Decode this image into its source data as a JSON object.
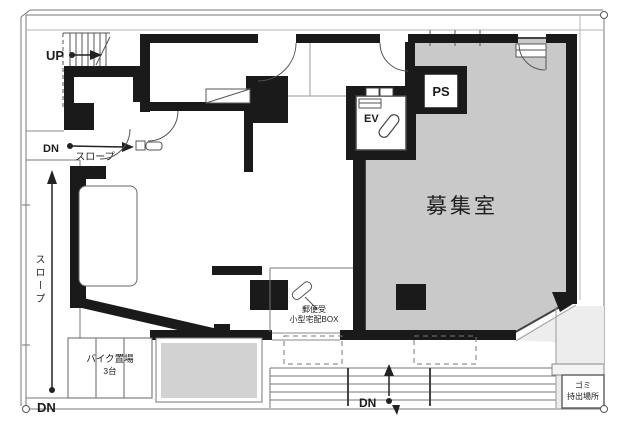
{
  "plan": {
    "room": {
      "name": "募集室"
    },
    "elevator": "EV",
    "pipe_shaft": "PS",
    "stairs_up": "UP",
    "down": "DN",
    "slope": "スロープ",
    "bike_parking": {
      "label": "バイク置場",
      "capacity": "3台"
    },
    "mail": {
      "line1": "郵便受",
      "line2": "小型宅配BOX"
    },
    "garbage": {
      "line1": "ゴミ",
      "line2": "持出場所"
    }
  },
  "colors": {
    "wall": "#1a1a1a",
    "room_fill": "#c9c9c9",
    "terrace_fill": "#d2d2d2",
    "exterior_fill": "#ededed",
    "line": "#666666"
  }
}
